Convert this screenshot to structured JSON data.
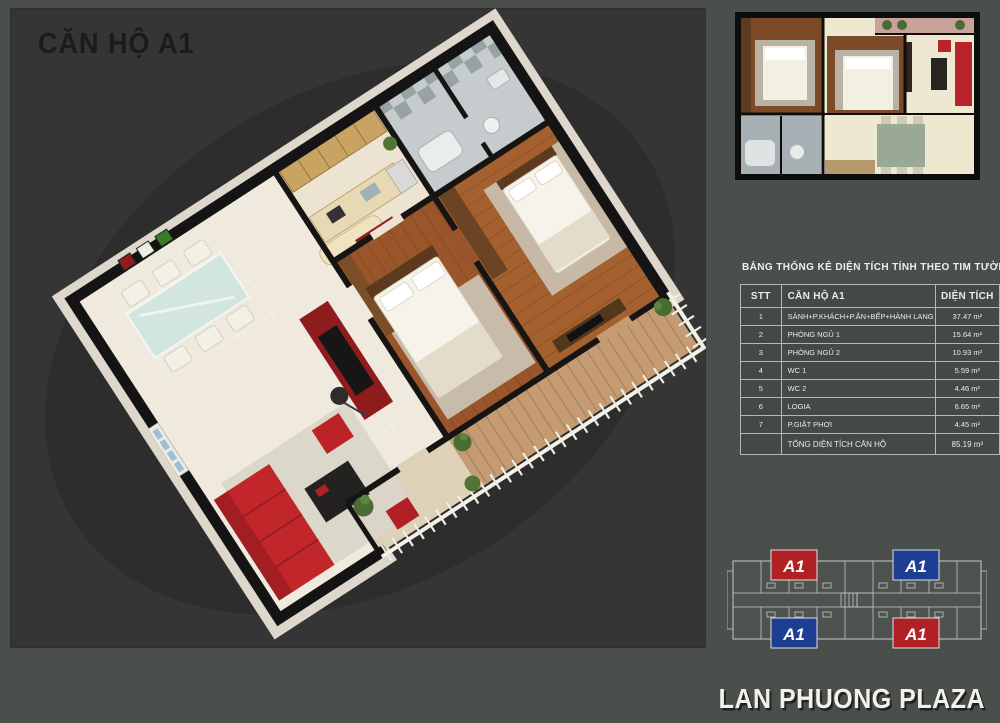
{
  "header": {
    "title": "CĂN HỘ A1"
  },
  "area_table": {
    "title": "BẢNG THỐNG KÊ DIỆN TÍCH TÍNH THEO TIM TƯỜNG",
    "columns": [
      "STT",
      "CĂN HỘ A1",
      "DIỆN TÍCH"
    ],
    "rows": [
      {
        "stt": "1",
        "name": "SẢNH+P.KHÁCH+P.ĂN+BẾP+HÀNH LANG",
        "area": "37.47 m²"
      },
      {
        "stt": "2",
        "name": "PHÒNG NGỦ 1",
        "area": "15.64 m²"
      },
      {
        "stt": "3",
        "name": "PHÒNG NGỦ 2",
        "area": "10.93 m²"
      },
      {
        "stt": "4",
        "name": "WC 1",
        "area": "5.59 m²"
      },
      {
        "stt": "5",
        "name": "WC 2",
        "area": "4.46 m²"
      },
      {
        "stt": "6",
        "name": "LOGIA",
        "area": "6.65 m²"
      },
      {
        "stt": "7",
        "name": "P.GIẶT PHƠI",
        "area": "4.45 m²"
      }
    ],
    "total": {
      "label": "TỔNG DIỆN TÍCH CĂN HỘ",
      "area": "85.19 m²"
    }
  },
  "floor_key": {
    "units": [
      {
        "label": "A1",
        "color": "#b02025",
        "position": "top-left"
      },
      {
        "label": "A1",
        "color": "#1d3e92",
        "position": "top-right"
      },
      {
        "label": "A1",
        "color": "#1d3e92",
        "position": "bottom-left"
      },
      {
        "label": "A1",
        "color": "#b02025",
        "position": "bottom-right"
      }
    ]
  },
  "footer": {
    "brand": "LAN PHUONG PLAZA"
  },
  "colors": {
    "page_background": "#4a4f4c",
    "panel_background": "#353535",
    "unit_red": "#b02025",
    "unit_blue": "#1d3e92",
    "sofa_red": "#c0262a"
  }
}
